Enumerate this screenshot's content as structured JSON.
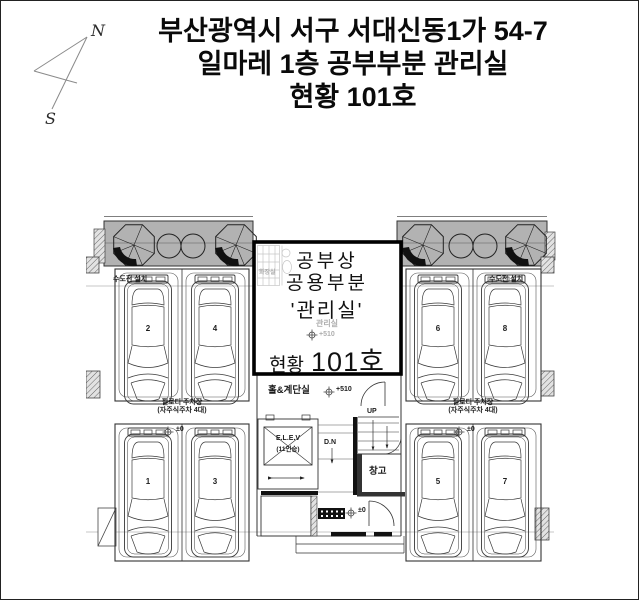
{
  "title": {
    "line1": "부산광역시 서구 서대신동1가 54-7",
    "line2": "일마레 1층 공부부분 관리실",
    "line3": "현황 101호"
  },
  "compass": {
    "north": "N",
    "south": "S"
  },
  "office": {
    "registry": "공부상",
    "common": "공용부분",
    "office_quoted": "'관리실'",
    "room_faint": "관리실",
    "level_faint": "+510",
    "status_label": "현황",
    "status_value": "101호",
    "bathroom": "화장실"
  },
  "hall": {
    "stair_hall": "홀&계단실",
    "stair_hall_level": "+510",
    "elevator": "E.L.E.V",
    "elevator_capacity": "(11인승)",
    "up": "UP",
    "down": "D.N",
    "storage": "창고",
    "entrance_level": "±0"
  },
  "left_wing": {
    "water": "수도전 설치",
    "parking_title": "필로티 주차장",
    "parking_sub": "(자주식주차 4대)",
    "row_level": "±0",
    "spots": [
      "2",
      "4",
      "1",
      "3"
    ]
  },
  "right_wing": {
    "water": "수도전 설치",
    "parking_title": "필로티 주차장",
    "parking_sub": "(자주식주차 4대)",
    "row_level": "±0",
    "spots": [
      "6",
      "8",
      "5",
      "7"
    ]
  },
  "colors": {
    "line": "#333333",
    "planter_fill": "#b2b2b2",
    "wall_black": "#111111",
    "faint": "#aeaeae"
  }
}
